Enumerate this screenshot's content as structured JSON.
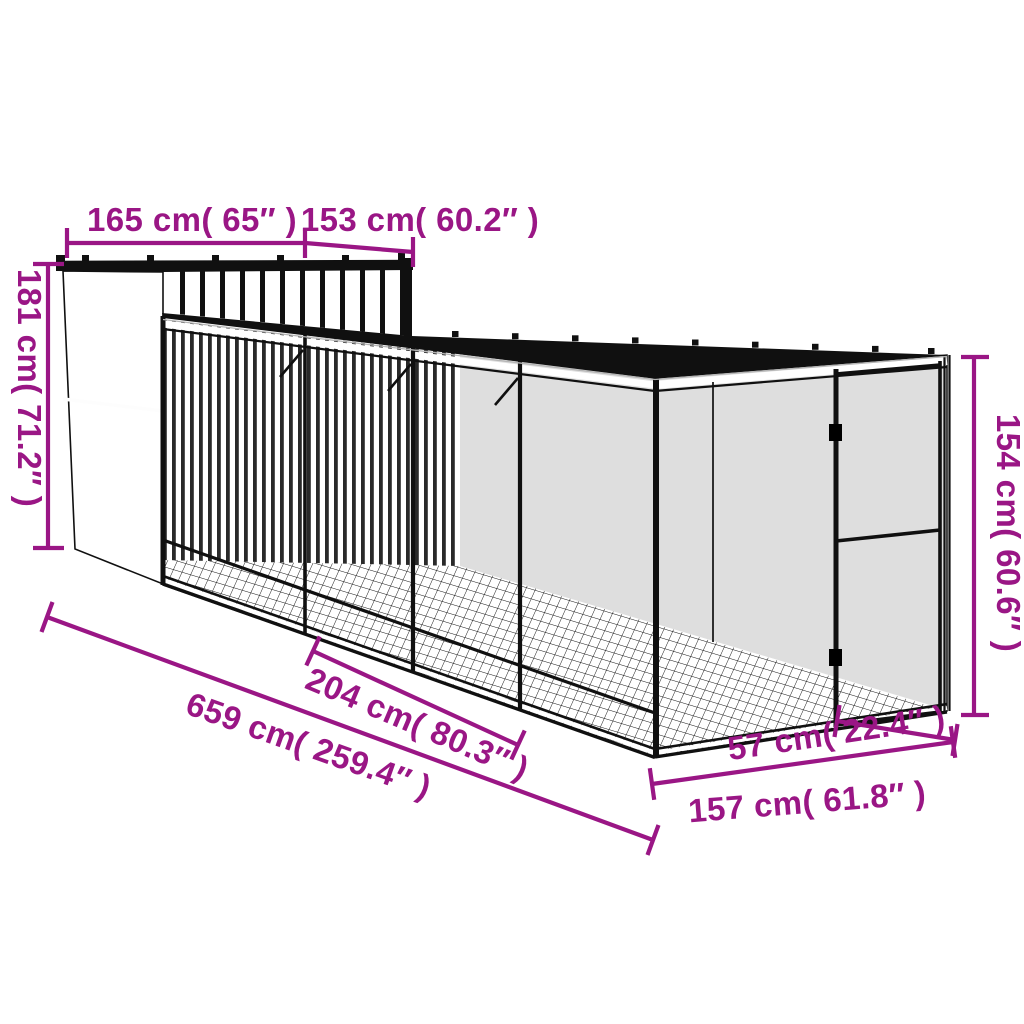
{
  "diagram": {
    "kind": "product dimension line drawing: chicken coop house with long roofed wire-mesh run and mesh door",
    "ink_color": "#101010",
    "dimension_color": "#9A1685",
    "background": "#FFFFFF"
  },
  "dimensions": {
    "house_width": {
      "label": "165 cm( 65″ )",
      "cm": 165,
      "inches": 65
    },
    "house_depth": {
      "label": "153 cm( 60.2″ )",
      "cm": 153,
      "inches": 60.2
    },
    "house_height": {
      "label": "181 cm( 71.2″ )",
      "cm": 181,
      "inches": 71.2
    },
    "run_height": {
      "label": "154 cm( 60.6″ )",
      "cm": 154,
      "inches": 60.6
    },
    "run_section_length": {
      "label": "204 cm( 80.3″ )",
      "cm": 204,
      "inches": 80.3
    },
    "total_length": {
      "label": "659 cm( 259.4″ )",
      "cm": 659,
      "inches": 259.4
    },
    "door_width": {
      "label": "57 cm( 22.4″ )",
      "cm": 57,
      "inches": 22.4
    },
    "end_width": {
      "label": "157 cm( 61.8″ )",
      "cm": 157,
      "inches": 61.8
    }
  }
}
